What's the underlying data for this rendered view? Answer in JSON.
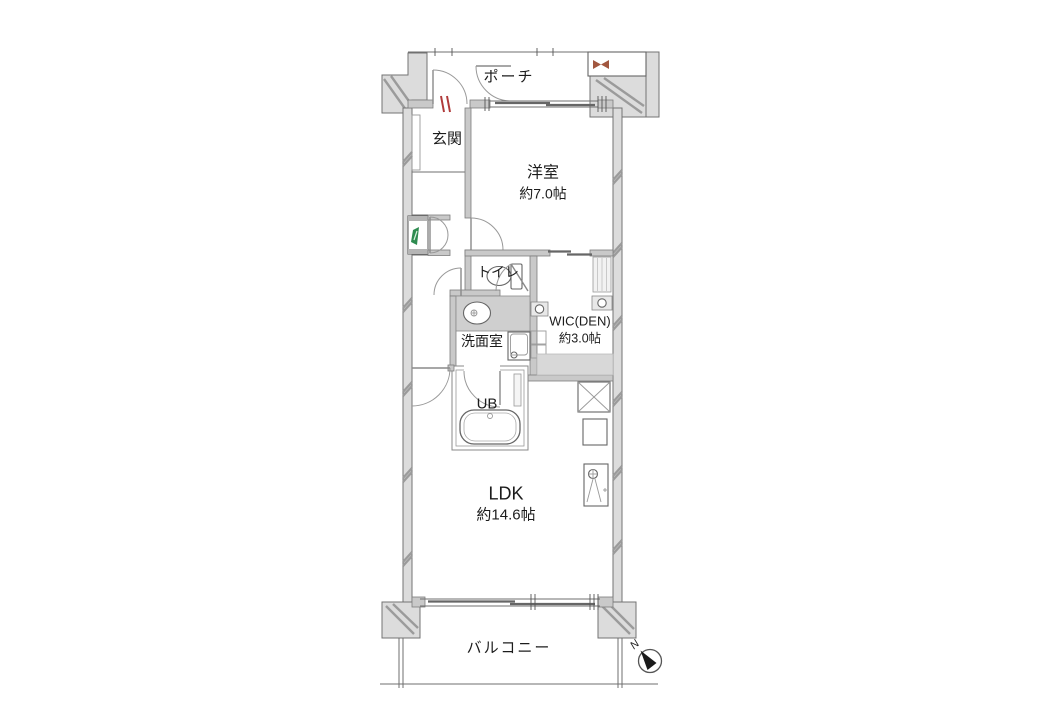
{
  "floorplan": {
    "rooms": {
      "porch": {
        "label": "ポーチ"
      },
      "entrance": {
        "label": "玄関"
      },
      "western_room": {
        "label": "洋室",
        "size": "約7.0帖"
      },
      "toilet": {
        "label": "トイレ"
      },
      "washroom": {
        "label": "洗面室"
      },
      "wic_den": {
        "label": "WIC(DEN)",
        "size": "約3.0帖"
      },
      "unit_bath": {
        "label": "UB"
      },
      "ldk": {
        "label": "LDK",
        "size": "約14.6帖"
      },
      "balcony": {
        "label": "バルコニー"
      }
    },
    "compass": {
      "north_label": "N"
    },
    "colors": {
      "background": "#ffffff",
      "wall_fill": "#dcdcdc",
      "interior_wall_fill": "#c9c9c9",
      "wall_edge": "#737373",
      "hatch": "#9b9b9b",
      "entry_door_mark_red": "#b03a3a",
      "meter_box_green": "#2e8b50",
      "meter_icon_brown": "#a2573f"
    }
  }
}
